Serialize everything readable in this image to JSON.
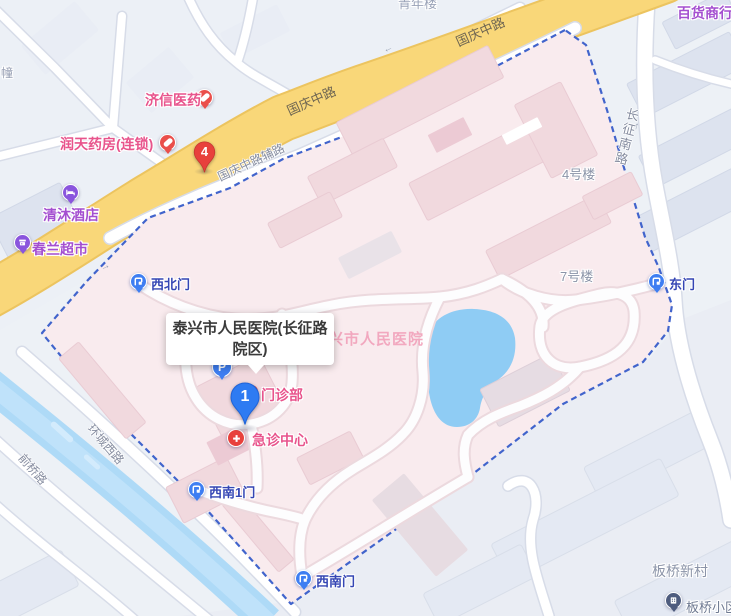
{
  "infobox": {
    "title": "泰兴市人民医院(长征路院区)"
  },
  "hospital": {
    "map_label": "泰兴市人民医院",
    "outpatient_label": "门诊部",
    "emergency_label": "急诊中心",
    "building_4": "4号楼",
    "building_7": "7号楼"
  },
  "markers": {
    "selected_number": "1",
    "numbered_pin": "4",
    "parking_letter": "P"
  },
  "gates": {
    "northwest": "西北门",
    "east": "东门",
    "southwest_1": "西南1门",
    "southwest": "西南门"
  },
  "pois": {
    "jixin_pharmacy": "济信医药",
    "runtian_pharmacy": "润天药房(连锁)",
    "qingmu_hotel": "清沐酒店",
    "chunlan_supermarket": "春兰超市",
    "department_store": "百货商行",
    "banqiao_community": "板桥小区",
    "banqiao_village": "板桥新村"
  },
  "roads": {
    "guoqing_mid_1": "国庆中路",
    "guoqing_mid_2": "国庆中路",
    "guoqing_frontage": "国庆中路辅路",
    "changzheng_south": "长征南路",
    "huancheng_west": "环城西路",
    "qianqiao": "前桥路"
  },
  "partial_labels": {
    "top_building": "青年楼",
    "left_building": "幢"
  },
  "arrows": {
    "up": "↑"
  },
  "colors": {
    "campus_fill": "#f9ebee",
    "boundary": "#4164cc",
    "main_road": "#f9d779",
    "water": "#aedaf7",
    "poi_medical": "#e8548c",
    "poi_shop": "#a44fd0",
    "gate_text": "#3546b4",
    "marker_blue": "#2e7bf2",
    "marker_red": "#e8413c"
  }
}
